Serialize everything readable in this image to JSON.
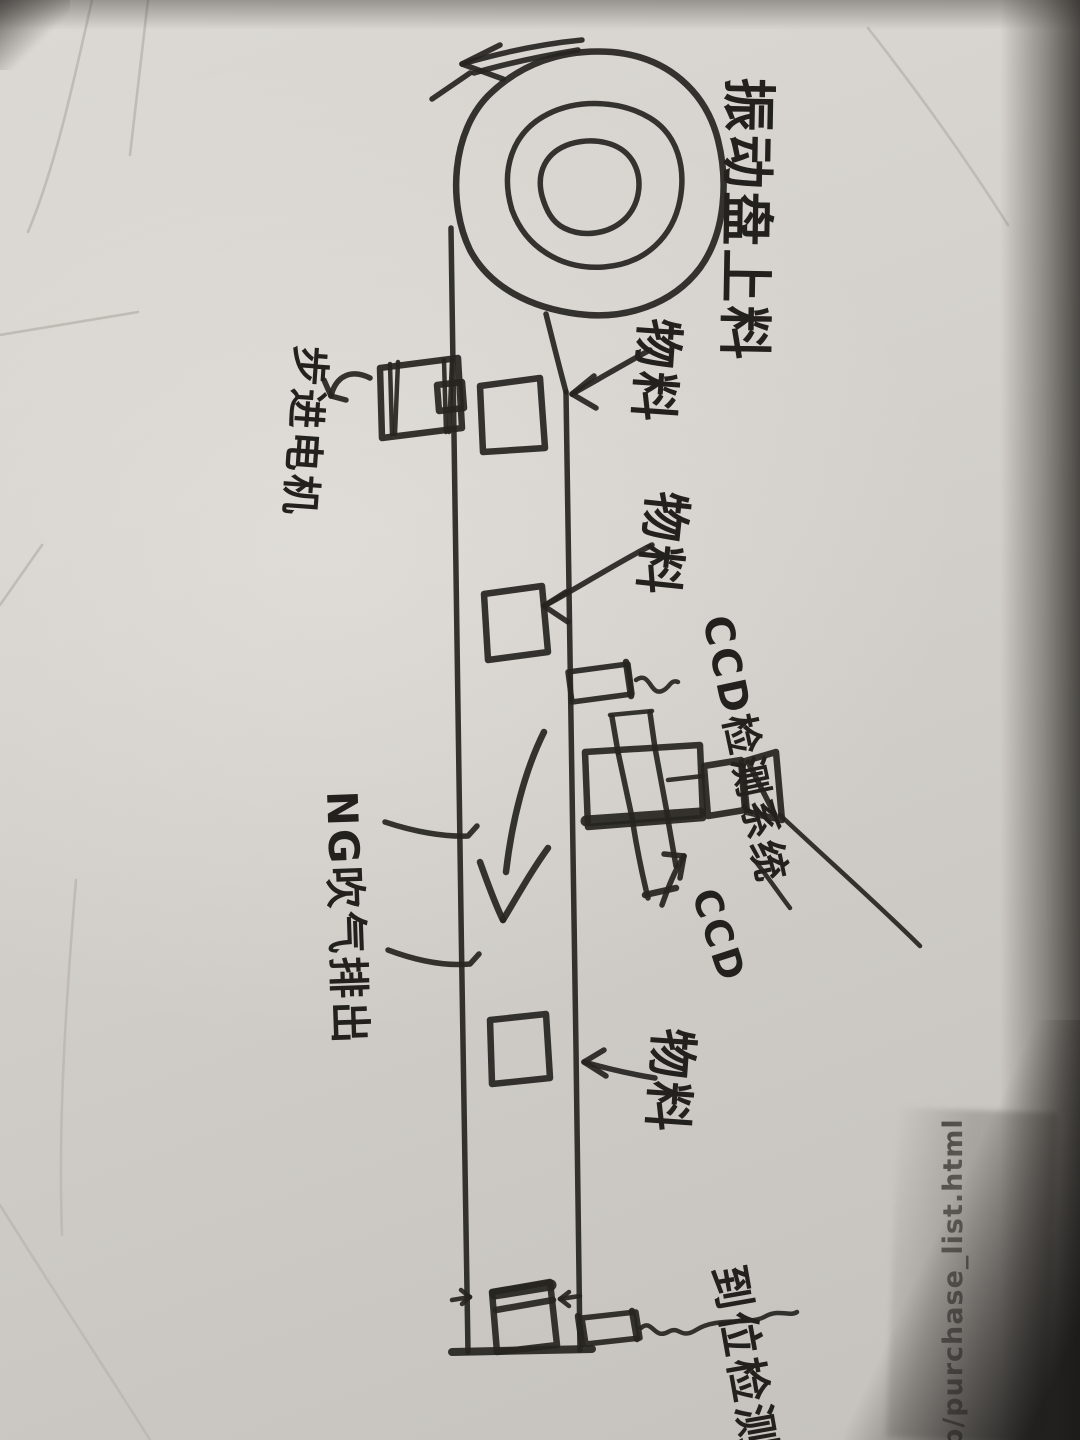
{
  "photo": {
    "labels": {
      "bowl_feeder": "振动盘上料",
      "material_top": "物料",
      "material_middle": "物料",
      "material_bottom": "物料",
      "stepper_motor": "步进电机",
      "ccd_system": "CCD检测系统",
      "ccd_pointer": "CCD",
      "ng_eject": "NG吹气排出",
      "in_position_sensor": "到位检测",
      "printed_edge_text": "b/purchase_list.html"
    },
    "colors": {
      "ink": "#262420",
      "paper": "#d4d1cc",
      "edge_shadow": "#2a2826",
      "printed_text": "#3b3935"
    }
  }
}
